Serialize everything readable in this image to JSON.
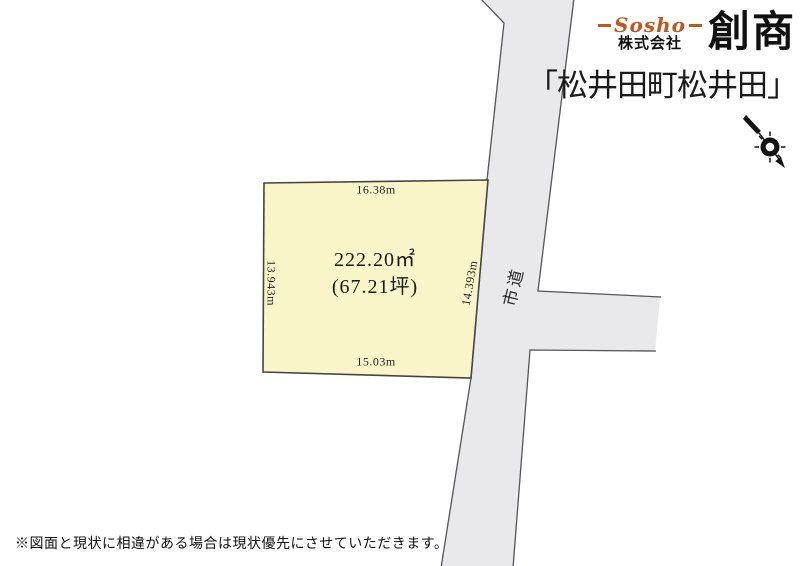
{
  "header": {
    "logo": {
      "script": "Sosho",
      "company_prefix": "株式会社",
      "company_name": "創商"
    },
    "title": "「松井田町松井田」"
  },
  "plot": {
    "area_sqm": "222.20㎡",
    "area_tsubo": "(67.21坪)",
    "dim_top": "16.38m",
    "dim_left": "13.943m",
    "dim_right": "14.393m",
    "dim_bottom": "15.03m"
  },
  "road": {
    "label": "市道"
  },
  "footer": {
    "disclaimer": "※図面と現状に相違がある場合は現状優先にさせていただきます。"
  },
  "colors": {
    "brand_orange": "#c2571c",
    "plot_fill": "#f8f6c9",
    "road_fill": "#e9e9eb",
    "plot_border": "#45453c",
    "road_border": "#55555a"
  }
}
